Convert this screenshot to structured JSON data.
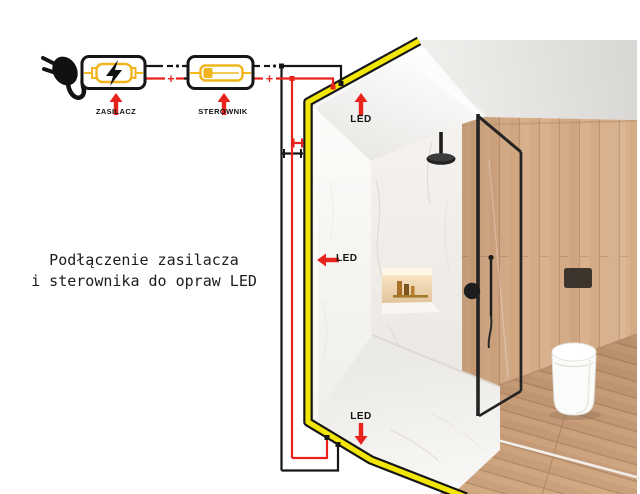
{
  "caption": {
    "line1": "Podłączenie zasilacza",
    "line2": "i sterownika do opraw LED"
  },
  "diagram": {
    "components": {
      "power_supply": "ZASILACZ",
      "controller": "STEROWNIK"
    },
    "led_labels": {
      "ceiling": "LED",
      "wall": "LED",
      "floor": "LED"
    },
    "wire_markers": {
      "positive": "+"
    },
    "colors": {
      "negative_wire": "#161616",
      "positive_wire": "#e8231c",
      "arrow_red": "#e8231c",
      "led_strip_yellow": "#f2e50a",
      "component_symbol_yellow": "#f0b51c"
    }
  }
}
